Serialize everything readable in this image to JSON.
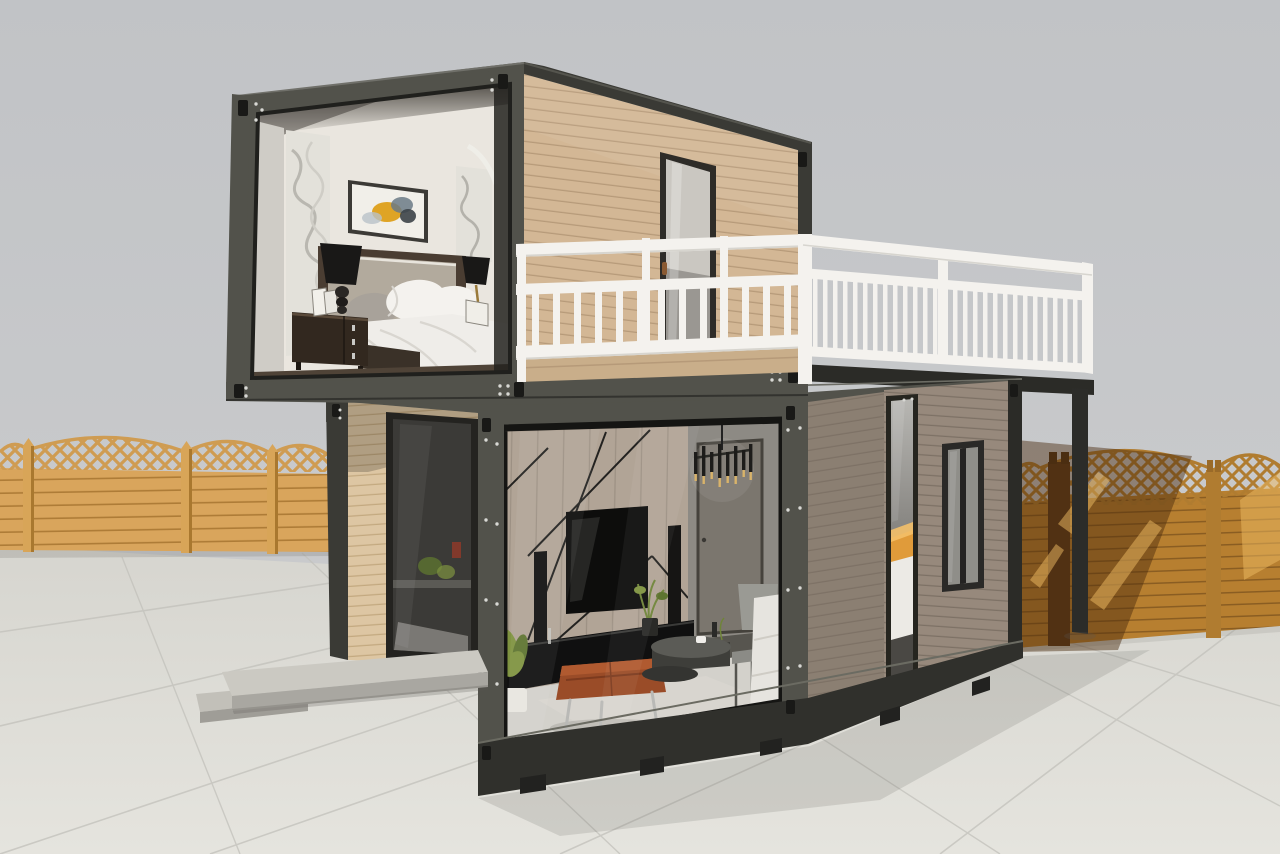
{
  "meta": {
    "description": "3D render of a two-storey flat-pack shipping-container house with cutaway walls revealing a furnished bedroom upstairs and a living room downstairs, a white-railed roof terrace, concrete paver yard and golden timber lattice-top fences under a gray sky",
    "render_type": "architectural-visualization"
  },
  "palette": {
    "sky1": "#c1c3c6",
    "sky2": "#cdcecf",
    "ground1": "#d6d5cf",
    "ground2": "#e5e4de",
    "tileLine": "#c2c1bb",
    "shadow": "#5a5852",
    "frame": "#52524b",
    "frameDark": "#3a3a35",
    "frameDarker": "#2b2b27",
    "frameLight": "#70706a",
    "casting": "#191917",
    "rivet": "#d8d8d4",
    "plankTanBase": "#d3b795",
    "plankTanLine": "#b69a79",
    "plankLightBase": "#ddc6a3",
    "plankLightLine": "#c3a980",
    "plankGrayBase": "#97897c",
    "plankGrayLine": "#7d7165",
    "plankGrayFrontBase": "#8b7f72",
    "deckWood": "#c9ae8a",
    "railWhite": "#f4f2ee",
    "railShade": "#d7d5cf",
    "doorGlassTop": "#cac7c1",
    "doorGlassBot": "#9a9792",
    "handleBrown": "#8a5a32",
    "darkGlass": "#3b3a37",
    "bedroomWall": "#eae6df",
    "panelCarve": "#e3e1da",
    "panelShadow": "#b4b2ab",
    "reveal": "#cfccc6",
    "artCanvas": "#f1efe9",
    "artFrame": "#3c3a36",
    "artYellow": "#dfa425",
    "artSlate": "#6b7a86",
    "artDark": "#3c4248",
    "headboardWood": "#4a3d32",
    "headboardFabric": "#b2aa9d",
    "pillowWhite": "#f4f2ee",
    "pillowGray": "#a8a29a",
    "duvet": "#efede9",
    "duvetFold": "#d9d6d0",
    "nightstand": "#32281f",
    "knob": "#c9c9c6",
    "lampBlack": "#191817",
    "gold": "#9a7a3a",
    "floorDark": "#4f4337",
    "wallWood": "#b1a496",
    "wallWoodLine": "#9c9083",
    "wallLine": "#232220",
    "tvBlack": "#0d0d0c",
    "console": "#101010",
    "leather": "#9a4c28",
    "leatherDark": "#7c3a1e",
    "rug": "#d8d6d0",
    "tableDark": "#3e3e3a",
    "tableTop": "#5b5b56",
    "chrome": "#b9b9b6",
    "sofa": "#e6e4df",
    "hallWall": "#8d8a84",
    "hallDoor": "#7b766e",
    "hallFloor": "#57554f",
    "intFloor": "#d3d1cb",
    "lampGray": "#9a9a94",
    "plantGreen": "#7f9340",
    "plantGreenDark": "#5e7430",
    "pot": "#e8e6e0",
    "potDark": "#2a2a27",
    "candle": "#d9b36a",
    "paneGlass": "#a8a7a3",
    "bedOrange": "#e09b3a",
    "bedWhite": "#eceae5",
    "winGlass": "#8f8e89",
    "skirt": "#30302c",
    "post": "#2c2c29",
    "fenceLight": "#d9a55c",
    "fenceLightLine": "#ae7c37",
    "fenceLattice": "#cf9c52",
    "fencePost": "#d8a558",
    "fencePostSide": "#a9782f",
    "fenceDark": "#b77f30",
    "fenceDarkLine": "#8a5d22",
    "fenceLatticeR": "#b07c30",
    "fenceBright": "#eebb63",
    "fenceShadow": "#46290c",
    "concrete": "#cbc9c2",
    "concreteRiser": "#a9a7a1",
    "concrete2": "#c2c0b9",
    "concreteRiser2": "#9f9d97"
  },
  "scene": {
    "environment": {
      "sky": "flat overcast gray backdrop",
      "ground": "large square concrete pavers with thin joints",
      "fence_left": "golden timber fence panels, horizontal boards with arched diamond-lattice tops and capped posts",
      "fence_right": "orange timber lattice-top fence, left half in building shadow, right half sunlit",
      "cast_shadow": "building shadow falling across pavers to the right"
    },
    "building": {
      "structure": "two stacked steel-framed container modules with corner castings and rivets",
      "upper_module": {
        "siding": "light tan horizontal plank cladding",
        "cutaway": "open front face revealing bedroom",
        "terrace_door": "dark-framed frosted glass door with brown handle",
        "roof_trim": "dark steel edge beams"
      },
      "lower_modules": {
        "left": "tan plank module with full-height dark sliding glass door",
        "center": "glass-walled living room cutaway",
        "right": "gray-brown plank module with narrow vertical glazing and a small double window"
      },
      "terrace": "white balustraded balcony deck over the lower modules, carried on a dark steel beam and slim corner post"
    },
    "bedroom": {
      "items": [
        "white textured walls",
        "two carved white relief panels",
        "abstract wall art in dark frame",
        "gray upholstered headboard bed",
        "white pillows and duvet",
        "dark wood nightstand with chrome knobs",
        "black shaded table lamps",
        "leaning photo frames",
        "white wall pipe"
      ]
    },
    "living_room": {
      "items": [
        "wood plank feature wall with black diagonal inlay lines",
        "wall-mounted flat TV",
        "black speaker columns",
        "low black media console",
        "tan leather ottoman on chrome legs",
        "round dark coffee table pair",
        "metal-frame side table",
        "gray drum floor lamp",
        "white sofa",
        "potted plants",
        "candle chandelier",
        "hallway door"
      ]
    },
    "exterior": {
      "steps": "low concrete entry platform and step",
      "support_post": "dark steel post under balcony end"
    }
  }
}
